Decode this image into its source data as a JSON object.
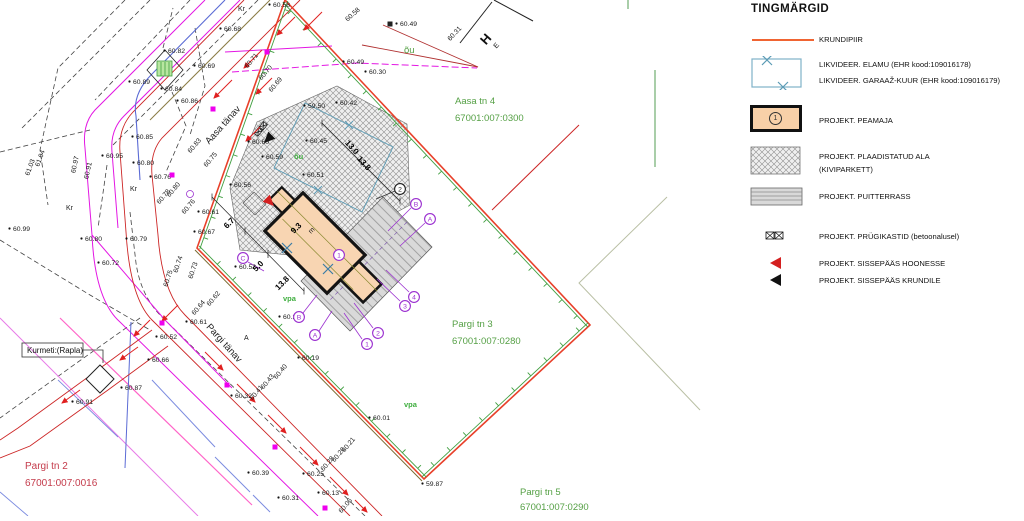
{
  "legend": {
    "title": "TINGMÄRGID",
    "items": [
      {
        "key": "krundipiir",
        "label": "KRUNDIPIIR"
      },
      {
        "key": "likvideer",
        "label": "LIKVIDEER. ELAMU (EHR kood:109016178)",
        "label2": "LIKVIDEER. GARAAŽ-KUUR (EHR kood:109016179)"
      },
      {
        "key": "peamaja",
        "label": "PROJEKT. PEAMAJA",
        "badge": "1"
      },
      {
        "key": "plaadistatud-ala",
        "label": "PROJEKT. PLAADISTATUD ALA",
        "label2": "(KIVIPARKETT)"
      },
      {
        "key": "puitterrass",
        "label": "PROJEKT. PUITTERRASS"
      },
      {
        "key": "prygikastid",
        "label": "PROJEKT. PRÜGIKASTID (betoonalusel)"
      },
      {
        "key": "sissepaas-hoonesse",
        "label": "PROJEKT. SISSEPÄÄS HOONESSE"
      },
      {
        "key": "sissepaas-krundile",
        "label": "PROJEKT. SISSEPÄÄS KRUNDILE"
      }
    ]
  },
  "colors": {
    "krundipiir": "#e8402a",
    "fence_green": "#3f9e3f",
    "area_green": "#55a045",
    "parcel_red_text": "#c43b4b",
    "utility_magenta": "#e316e3",
    "street_red": "#cc2525",
    "likvideer_blue": "#5b9bb5",
    "building_fill": "#f8d5b2",
    "marker_purple": "#9b30d0"
  },
  "plan": {
    "labels": [
      {
        "t": "60.82",
        "x": 168,
        "y": 53,
        "k": "e"
      },
      {
        "t": "60.69",
        "x": 198,
        "y": 68,
        "k": "e"
      },
      {
        "t": "60.89",
        "x": 133,
        "y": 84,
        "k": "e"
      },
      {
        "t": "60.84",
        "x": 165,
        "y": 91,
        "k": "e"
      },
      {
        "t": "60.86",
        "x": 181,
        "y": 103,
        "k": "e"
      },
      {
        "t": "60.68",
        "x": 224,
        "y": 31,
        "k": "e"
      },
      {
        "t": "60.58",
        "x": 273,
        "y": 7,
        "k": "e"
      },
      {
        "t": "60.58",
        "x": 354,
        "y": 16,
        "k": "er",
        "r": -42
      },
      {
        "t": "60.49",
        "x": 400,
        "y": 26,
        "k": "e"
      },
      {
        "t": "60.49",
        "x": 347,
        "y": 64,
        "k": "e"
      },
      {
        "t": "60.30",
        "x": 369,
        "y": 74,
        "k": "e"
      },
      {
        "t": "60.31",
        "x": 456,
        "y": 35,
        "k": "er",
        "r": -47
      },
      {
        "t": "60.71",
        "x": 253,
        "y": 62,
        "k": "er",
        "r": -50
      },
      {
        "t": "60.70",
        "x": 267,
        "y": 74,
        "k": "er",
        "r": -50
      },
      {
        "t": "60.69",
        "x": 277,
        "y": 86,
        "k": "er",
        "r": -50
      },
      {
        "t": "60.83",
        "x": 196,
        "y": 147,
        "k": "er",
        "r": -50
      },
      {
        "t": "60.75",
        "x": 212,
        "y": 161,
        "k": "er",
        "r": -50
      },
      {
        "t": "60.85",
        "x": 136,
        "y": 139,
        "k": "e"
      },
      {
        "t": "60.95",
        "x": 106,
        "y": 158,
        "k": "e"
      },
      {
        "t": "60.80",
        "x": 137,
        "y": 165,
        "k": "e"
      },
      {
        "t": "60.76",
        "x": 154,
        "y": 179,
        "k": "e"
      },
      {
        "t": "61.04",
        "x": 42,
        "y": 159,
        "k": "er",
        "r": -70
      },
      {
        "t": "61.03",
        "x": 32,
        "y": 168,
        "k": "er",
        "r": -70
      },
      {
        "t": "60.97",
        "x": 77,
        "y": 165,
        "k": "er",
        "r": -78
      },
      {
        "t": "60.91",
        "x": 90,
        "y": 171,
        "k": "er",
        "r": -78
      },
      {
        "t": "60.99",
        "x": 13,
        "y": 231,
        "k": "e"
      },
      {
        "t": "60.80",
        "x": 85,
        "y": 241,
        "k": "e"
      },
      {
        "t": "60.79",
        "x": 130,
        "y": 241,
        "k": "e"
      },
      {
        "t": "60.72",
        "x": 102,
        "y": 265,
        "k": "e"
      },
      {
        "t": "60.78",
        "x": 165,
        "y": 198,
        "k": "er",
        "r": -50
      },
      {
        "t": "60.80",
        "x": 175,
        "y": 191,
        "k": "er",
        "r": -50
      },
      {
        "t": "60.76",
        "x": 190,
        "y": 208,
        "k": "er",
        "r": -50
      },
      {
        "t": "60.74",
        "x": 180,
        "y": 265,
        "k": "er",
        "r": -72
      },
      {
        "t": "60.75",
        "x": 170,
        "y": 279,
        "k": "er",
        "r": -72
      },
      {
        "t": "60.73",
        "x": 195,
        "y": 271,
        "k": "er",
        "r": -72
      },
      {
        "t": "60.62",
        "x": 215,
        "y": 300,
        "k": "er",
        "r": -50
      },
      {
        "t": "60.64",
        "x": 200,
        "y": 309,
        "k": "er",
        "r": -50
      },
      {
        "t": "60.61",
        "x": 190,
        "y": 324,
        "k": "e"
      },
      {
        "t": "60.52",
        "x": 160,
        "y": 339,
        "k": "e"
      },
      {
        "t": "60.66",
        "x": 152,
        "y": 362,
        "k": "e"
      },
      {
        "t": "60.87",
        "x": 125,
        "y": 390,
        "k": "e"
      },
      {
        "t": "60.91",
        "x": 76,
        "y": 404,
        "k": "e"
      },
      {
        "t": "60.32",
        "x": 235,
        "y": 398,
        "k": "e"
      },
      {
        "t": "60.19",
        "x": 302,
        "y": 360,
        "k": "e"
      },
      {
        "t": "60.40",
        "x": 282,
        "y": 373,
        "k": "er",
        "r": -50
      },
      {
        "t": "60.43",
        "x": 269,
        "y": 383,
        "k": "er",
        "r": -50
      },
      {
        "t": "60.41",
        "x": 258,
        "y": 394,
        "k": "er",
        "r": -50
      },
      {
        "t": "60.01",
        "x": 373,
        "y": 420,
        "k": "e"
      },
      {
        "t": "60.21",
        "x": 350,
        "y": 446,
        "k": "er",
        "r": -50
      },
      {
        "t": "60.26",
        "x": 340,
        "y": 456,
        "k": "er",
        "r": -50
      },
      {
        "t": "60.28",
        "x": 329,
        "y": 465,
        "k": "er",
        "r": -50
      },
      {
        "t": "60.25",
        "x": 307,
        "y": 476,
        "k": "e"
      },
      {
        "t": "60.39",
        "x": 252,
        "y": 475,
        "k": "e"
      },
      {
        "t": "60.31",
        "x": 282,
        "y": 500,
        "k": "e"
      },
      {
        "t": "60.13",
        "x": 322,
        "y": 495,
        "k": "e"
      },
      {
        "t": "60.06",
        "x": 347,
        "y": 507,
        "k": "er",
        "r": -50
      },
      {
        "t": "59.87",
        "x": 426,
        "y": 486,
        "k": "e"
      },
      {
        "t": "60.56",
        "x": 234,
        "y": 187,
        "k": "e"
      },
      {
        "t": "60.61",
        "x": 202,
        "y": 214,
        "k": "e"
      },
      {
        "t": "60.67",
        "x": 198,
        "y": 234,
        "k": "e"
      },
      {
        "t": "59.50",
        "x": 308,
        "y": 108,
        "k": "e"
      },
      {
        "t": "60.42",
        "x": 340,
        "y": 105,
        "k": "e"
      },
      {
        "t": "60.45",
        "x": 310,
        "y": 143,
        "k": "e"
      },
      {
        "t": "60.60",
        "x": 252,
        "y": 144,
        "k": "e"
      },
      {
        "t": "60.59",
        "x": 266,
        "y": 159,
        "k": "e"
      },
      {
        "t": "60.51",
        "x": 307,
        "y": 177,
        "k": "e"
      },
      {
        "t": "60.52",
        "x": 239,
        "y": 269,
        "k": "e"
      },
      {
        "t": "60.26",
        "x": 283,
        "y": 319,
        "k": "e"
      },
      {
        "t": "6.7",
        "x": 231,
        "y": 225,
        "k": "d",
        "r": -45
      },
      {
        "t": "9.3",
        "x": 298,
        "y": 230,
        "k": "d",
        "r": -45
      },
      {
        "t": "5.0",
        "x": 260,
        "y": 268,
        "k": "d",
        "r": -45
      },
      {
        "t": "13.8",
        "x": 284,
        "y": 285,
        "k": "d",
        "r": -45
      },
      {
        "t": "13.0",
        "x": 350,
        "y": 149,
        "k": "d",
        "r": 48
      },
      {
        "t": "13.8",
        "x": 362,
        "y": 165,
        "k": "d",
        "r": 48
      },
      {
        "t": "Aasa tn 4",
        "x": 455,
        "y": 104,
        "k": "g"
      },
      {
        "t": "67001:007:0300",
        "x": 455,
        "y": 121,
        "k": "g"
      },
      {
        "t": "Pargi tn 3",
        "x": 452,
        "y": 327,
        "k": "g"
      },
      {
        "t": "67001:007:0280",
        "x": 452,
        "y": 344,
        "k": "g"
      },
      {
        "t": "Pargi tn 5",
        "x": 520,
        "y": 495,
        "k": "g"
      },
      {
        "t": "67001:007:0290",
        "x": 520,
        "y": 510,
        "k": "g"
      },
      {
        "t": "Pargi tn 2",
        "x": 25,
        "y": 469,
        "k": "r2"
      },
      {
        "t": "67001:007:0016",
        "x": 25,
        "y": 486,
        "k": "r2"
      },
      {
        "t": "õu",
        "x": 404,
        "y": 53,
        "k": "g"
      },
      {
        "t": "õu",
        "x": 294,
        "y": 159,
        "k": "gs"
      },
      {
        "t": "vpa",
        "x": 283,
        "y": 301,
        "k": "gs"
      },
      {
        "t": "vpa",
        "x": 404,
        "y": 407,
        "k": "gs"
      },
      {
        "t": "Kr",
        "x": 238,
        "y": 11,
        "k": "e2"
      },
      {
        "t": "Kr",
        "x": 130,
        "y": 191,
        "k": "e2"
      },
      {
        "t": "Kr",
        "x": 66,
        "y": 210,
        "k": "e2"
      },
      {
        "t": "A",
        "x": 244,
        "y": 340,
        "k": "e2"
      },
      {
        "t": "m",
        "x": 311,
        "y": 234,
        "k": "e2",
        "r": -45
      },
      {
        "t": "Aasa tänav",
        "x": 225,
        "y": 127,
        "k": "st",
        "r": -48
      },
      {
        "t": "Pargi tänav",
        "x": 222,
        "y": 345,
        "k": "st",
        "r": 48
      },
      {
        "t": "Kurmeti:(Rapla)",
        "x": 27,
        "y": 353,
        "k": "note"
      },
      {
        "t": "H",
        "x": 489,
        "y": 42,
        "k": "he",
        "r": -48
      },
      {
        "t": "E",
        "x": 498,
        "y": 47,
        "k": "he2",
        "r": -48
      }
    ],
    "circle_markers": [
      {
        "t": "B",
        "x": 416,
        "y": 204,
        "c": "p"
      },
      {
        "t": "A",
        "x": 430,
        "y": 219,
        "c": "p"
      },
      {
        "t": "C",
        "x": 243,
        "y": 258,
        "c": "p"
      },
      {
        "t": "B",
        "x": 299,
        "y": 317,
        "c": "p"
      },
      {
        "t": "A",
        "x": 315,
        "y": 335,
        "c": "p"
      },
      {
        "t": "4",
        "x": 414,
        "y": 297,
        "c": "p"
      },
      {
        "t": "3",
        "x": 405,
        "y": 306,
        "c": "p"
      },
      {
        "t": "2",
        "x": 378,
        "y": 333,
        "c": "p"
      },
      {
        "t": "1",
        "x": 367,
        "y": 344,
        "c": "p"
      },
      {
        "t": "2",
        "x": 400,
        "y": 189,
        "c": "k"
      },
      {
        "t": "1",
        "x": 339,
        "y": 255,
        "c": "p"
      }
    ],
    "utility_markers_magenta": [
      [
        267,
        52
      ],
      [
        213,
        109
      ],
      [
        172,
        175
      ],
      [
        162,
        323
      ],
      [
        227,
        385
      ],
      [
        275,
        447
      ],
      [
        325,
        508
      ]
    ],
    "utility_markers_black": [
      [
        390,
        24
      ]
    ],
    "boundary_parcel": [
      [
        285,
        0
      ],
      [
        590,
        325
      ],
      [
        424,
        479
      ],
      [
        197,
        248
      ]
    ]
  }
}
